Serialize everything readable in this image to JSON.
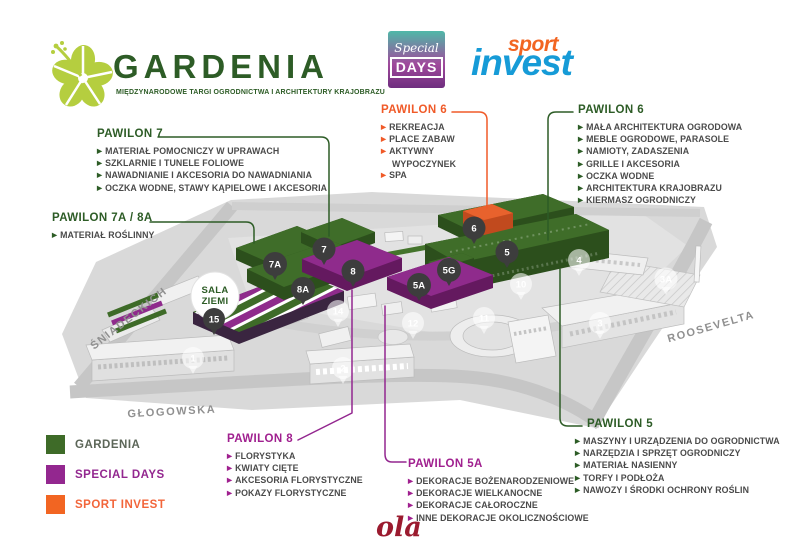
{
  "header": {
    "gardenia": {
      "title": "GARDENIA",
      "subtitle": "MIĘDZYNARODOWE TARGI OGRODNICTWA I ARCHITEKTURY KRAJOBRAZU"
    },
    "special_days": {
      "word1": "Special",
      "word2": "DAYS"
    },
    "sport_invest": {
      "word1": "sport",
      "word2": "invest"
    }
  },
  "callouts": [
    {
      "id": "pawilon-7",
      "title": "PAWILON 7",
      "theme": "green",
      "items": [
        "MATERIAŁ POMOCNICZY W UPRAWACH",
        "SZKLARNIE I TUNELE FOLIOWE",
        "NAWADNIANIE I AKCESORIA DO NAWADNIANIA",
        "OCZKA WODNE, STAWY KĄPIELOWE I AKCESORIA"
      ]
    },
    {
      "id": "pawilon-7a-8a",
      "title": "PAWILON 7A / 8A",
      "theme": "green",
      "items": [
        "MATERIAŁ ROŚLINNY"
      ]
    },
    {
      "id": "pawilon-6-sport",
      "title": "PAWILON 6",
      "theme": "orange",
      "items": [
        "REKREACJA",
        "PLACE ZABAW",
        "AKTYWNY WYPOCZYNEK",
        "SPA"
      ]
    },
    {
      "id": "pawilon-6",
      "title": "PAWILON 6",
      "theme": "green",
      "items": [
        "MAŁA ARCHITEKTURA OGRODOWA",
        "MEBLE OGRODOWE, PARASOLE",
        "NAMIOTY, ZADASZENIA",
        "GRILLE I AKCESORIA",
        "OCZKA WODNE",
        "ARCHITEKTURA KRAJOBRAZU",
        "KIERMASZ OGRODNICZY"
      ]
    },
    {
      "id": "pawilon-8",
      "title": "PAWILON 8",
      "theme": "purple",
      "items": [
        "FLORYSTYKA",
        "KWIATY CIĘTE",
        "AKCESORIA FLORYSTYCZNE",
        "POKAZY FLORYSTYCZNE"
      ]
    },
    {
      "id": "pawilon-5a",
      "title": "PAWILON 5A",
      "theme": "purple",
      "items": [
        "DEKORACJE BOŻENARODZENIOWE",
        "DEKORACJE WIELKANOCNE",
        "DEKORACJE CAŁOROCZNE",
        "INNE DEKORACJE OKOLICZNOŚCIOWE"
      ]
    },
    {
      "id": "pawilon-5",
      "title": "PAWILON 5",
      "theme": "green",
      "items": [
        "MASZYNY I URZĄDZENIA DO OGRODNICTWA",
        "NARZĘDZIA I SPRZĘT OGRODNICZY",
        "MATERIAŁ NASIENNY",
        "TORFY I PODŁOŻA",
        "NAWOZY I ŚRODKI OCHRONY ROŚLIN"
      ]
    }
  ],
  "legend": {
    "items": [
      {
        "label": "GARDENIA",
        "color": "#3e6b28"
      },
      {
        "label": "SPECIAL DAYS",
        "color": "#93278f"
      },
      {
        "label": "SPORT INVEST",
        "color": "#f26522"
      }
    ]
  },
  "map": {
    "streets": {
      "sniadeckich": "ŚNIADECKICH",
      "glogowska": "GŁOGOWSKA",
      "rooswelta": "ROOSEVELTA"
    },
    "sala_ziemi": {
      "line1": "SALA",
      "line2": "ZIEMI",
      "marker": "15"
    },
    "hall_markers": [
      "7A",
      "7",
      "8",
      "8A",
      "5A",
      "5G",
      "6",
      "5"
    ],
    "building_markers": [
      "1",
      "2",
      "3",
      "3A",
      "4",
      "10",
      "11",
      "12",
      "14"
    ]
  },
  "footer": {
    "signature": "ola"
  },
  "colors": {
    "gardenia_green": "#3e6b28",
    "heading_green": "#2d5c26",
    "special_purple": "#93278f",
    "sport_orange": "#f26522",
    "map_gray": "#d9d9d9"
  }
}
